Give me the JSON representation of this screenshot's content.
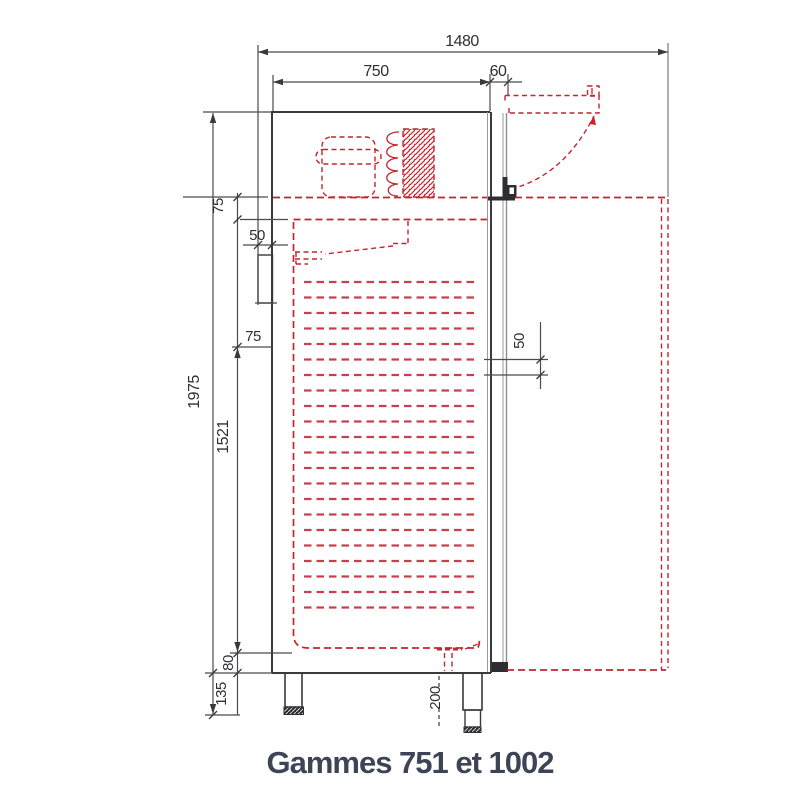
{
  "drawing": {
    "caption": "Gammes 751 et 1002",
    "unit": "mm",
    "dimensions": {
      "overall_depth_open": "1480",
      "body_depth": "750",
      "door_thickness": "60",
      "overall_height": "1975",
      "interior_height": "1521",
      "top_compartment_offset": "75",
      "rear_wall_clearance": "50",
      "liner_upper_offset": "75",
      "shelf_runner_pitch": "50",
      "base_inset": "80",
      "rear_foot_height": "135",
      "front_foot_height": "200"
    },
    "features": {
      "shelf_runner_count": 22
    },
    "colors": {
      "outline": "#3a3a3e",
      "secondary_line": "#8d8d92",
      "red_hidden_lines": "#c4252f",
      "dimension_text": "#2f2f33",
      "caption_text": "#3d4456"
    }
  }
}
